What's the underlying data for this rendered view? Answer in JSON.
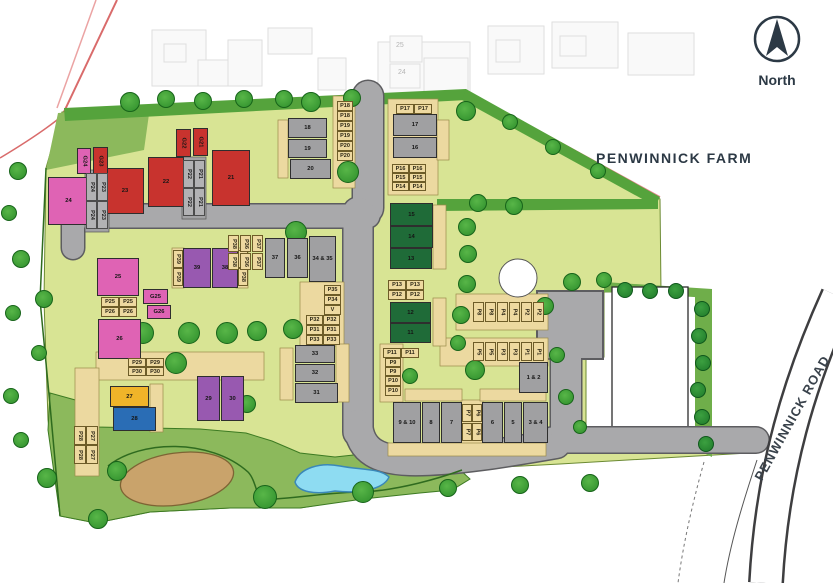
{
  "header": {
    "north_label": "North",
    "farm_label": "PENWINNICK FARM",
    "road_label": "PENWINNICK ROAD"
  },
  "background": {
    "faded_numbers": [
      "25",
      "24"
    ]
  },
  "colors": {
    "red": "#c8332e",
    "pink": "#df63b4",
    "purple": "#9859b0",
    "gray": "#a0a0a2",
    "darkgreen": "#1f6b38",
    "yellow": "#f0b429",
    "blue": "#2a6db5",
    "road": "#a9a9ab",
    "tan": "#eed9a0",
    "pale_green": "#d8e494",
    "meadow_green": "#8cb95c",
    "hedge_green": "#55a33c",
    "pond_blue": "#8edcf2",
    "sand": "#c9a36b",
    "ink": "#2c3945",
    "boundary_red": "#e07a7a"
  },
  "plots": {
    "buildings": [
      {
        "label": "21",
        "c": "red",
        "x": 212,
        "y": 150,
        "w": 38,
        "h": 56
      },
      {
        "label": "22",
        "c": "red",
        "x": 148,
        "y": 157,
        "w": 36,
        "h": 50
      },
      {
        "label": "23",
        "c": "red",
        "x": 106,
        "y": 168,
        "w": 38,
        "h": 46
      },
      {
        "label": "24",
        "c": "pink",
        "x": 48,
        "y": 177,
        "w": 41,
        "h": 48
      },
      {
        "label": "G24",
        "c": "pink",
        "x": 77,
        "y": 148,
        "w": 14,
        "h": 26,
        "r": 1
      },
      {
        "label": "G23",
        "c": "red",
        "x": 93,
        "y": 147,
        "w": 15,
        "h": 27,
        "r": 1
      },
      {
        "label": "G22",
        "c": "red",
        "x": 176,
        "y": 129,
        "w": 15,
        "h": 28,
        "r": 1
      },
      {
        "label": "G21",
        "c": "red",
        "x": 193,
        "y": 128,
        "w": 15,
        "h": 28,
        "r": 1
      },
      {
        "label": "25",
        "c": "pink",
        "x": 97,
        "y": 258,
        "w": 42,
        "h": 38
      },
      {
        "label": "G25",
        "c": "pink",
        "x": 143,
        "y": 289,
        "w": 25,
        "h": 15
      },
      {
        "label": "G26",
        "c": "pink",
        "x": 147,
        "y": 305,
        "w": 24,
        "h": 14
      },
      {
        "label": "26",
        "c": "pink",
        "x": 98,
        "y": 319,
        "w": 43,
        "h": 40
      },
      {
        "label": "39",
        "c": "purple",
        "x": 183,
        "y": 248,
        "w": 28,
        "h": 40
      },
      {
        "label": "38",
        "c": "purple",
        "x": 212,
        "y": 248,
        "w": 26,
        "h": 40
      },
      {
        "label": "37",
        "c": "gray",
        "x": 265,
        "y": 238,
        "w": 20,
        "h": 40
      },
      {
        "label": "36",
        "c": "gray",
        "x": 287,
        "y": 238,
        "w": 21,
        "h": 40
      },
      {
        "label": "34 & 35",
        "c": "gray",
        "x": 309,
        "y": 236,
        "w": 27,
        "h": 46
      },
      {
        "label": "18",
        "c": "gray",
        "x": 288,
        "y": 118,
        "w": 39,
        "h": 20
      },
      {
        "label": "19",
        "c": "gray",
        "x": 288,
        "y": 139,
        "w": 39,
        "h": 19
      },
      {
        "label": "20",
        "c": "gray",
        "x": 290,
        "y": 159,
        "w": 41,
        "h": 20
      },
      {
        "label": "17",
        "c": "gray",
        "x": 393,
        "y": 114,
        "w": 44,
        "h": 22
      },
      {
        "label": "16",
        "c": "gray",
        "x": 393,
        "y": 137,
        "w": 44,
        "h": 21
      },
      {
        "label": "15",
        "c": "darkgreen",
        "x": 390,
        "y": 203,
        "w": 43,
        "h": 23
      },
      {
        "label": "14",
        "c": "darkgreen",
        "x": 390,
        "y": 226,
        "w": 43,
        "h": 22
      },
      {
        "label": "13",
        "c": "darkgreen",
        "x": 390,
        "y": 248,
        "w": 42,
        "h": 21
      },
      {
        "label": "12",
        "c": "darkgreen",
        "x": 390,
        "y": 302,
        "w": 41,
        "h": 21
      },
      {
        "label": "11",
        "c": "darkgreen",
        "x": 390,
        "y": 323,
        "w": 41,
        "h": 20
      },
      {
        "label": "33",
        "c": "gray",
        "x": 295,
        "y": 345,
        "w": 40,
        "h": 18
      },
      {
        "label": "32",
        "c": "gray",
        "x": 295,
        "y": 364,
        "w": 40,
        "h": 18
      },
      {
        "label": "31",
        "c": "gray",
        "x": 295,
        "y": 383,
        "w": 43,
        "h": 20
      },
      {
        "label": "29",
        "c": "purple",
        "x": 197,
        "y": 376,
        "w": 23,
        "h": 45
      },
      {
        "label": "30",
        "c": "purple",
        "x": 221,
        "y": 376,
        "w": 23,
        "h": 45
      },
      {
        "label": "27",
        "c": "yellow",
        "x": 110,
        "y": 386,
        "w": 39,
        "h": 21
      },
      {
        "label": "28",
        "c": "blue",
        "x": 113,
        "y": 407,
        "w": 43,
        "h": 24
      },
      {
        "label": "9 & 10",
        "c": "gray",
        "x": 393,
        "y": 402,
        "w": 28,
        "h": 41
      },
      {
        "label": "8",
        "c": "gray",
        "x": 422,
        "y": 402,
        "w": 18,
        "h": 41
      },
      {
        "label": "7",
        "c": "gray",
        "x": 441,
        "y": 402,
        "w": 21,
        "h": 41
      },
      {
        "label": "6",
        "c": "gray",
        "x": 482,
        "y": 402,
        "w": 21,
        "h": 41
      },
      {
        "label": "5",
        "c": "gray",
        "x": 504,
        "y": 402,
        "w": 18,
        "h": 41
      },
      {
        "label": "3 & 4",
        "c": "gray",
        "x": 523,
        "y": 402,
        "w": 25,
        "h": 41
      },
      {
        "label": "1 & 2",
        "c": "gray",
        "x": 519,
        "y": 362,
        "w": 29,
        "h": 31
      }
    ]
  },
  "parking": [
    {
      "t": "P18",
      "x": 337,
      "y": 101,
      "w": 16,
      "h": 10
    },
    {
      "t": "P18",
      "x": 337,
      "y": 111,
      "w": 16,
      "h": 10
    },
    {
      "t": "P19",
      "x": 337,
      "y": 121,
      "w": 16,
      "h": 10
    },
    {
      "t": "P19",
      "x": 337,
      "y": 131,
      "w": 16,
      "h": 10
    },
    {
      "t": "P20",
      "x": 337,
      "y": 141,
      "w": 16,
      "h": 10
    },
    {
      "t": "P20",
      "x": 337,
      "y": 151,
      "w": 16,
      "h": 10
    },
    {
      "t": "P17",
      "x": 396,
      "y": 104,
      "w": 18,
      "h": 10
    },
    {
      "t": "P17",
      "x": 414,
      "y": 104,
      "w": 18,
      "h": 10
    },
    {
      "t": "P16",
      "x": 392,
      "y": 164,
      "w": 17,
      "h": 9
    },
    {
      "t": "P16",
      "x": 409,
      "y": 164,
      "w": 17,
      "h": 9
    },
    {
      "t": "P15",
      "x": 392,
      "y": 173,
      "w": 17,
      "h": 9
    },
    {
      "t": "P15",
      "x": 409,
      "y": 173,
      "w": 17,
      "h": 9
    },
    {
      "t": "P14",
      "x": 392,
      "y": 182,
      "w": 17,
      "h": 9
    },
    {
      "t": "P14",
      "x": 409,
      "y": 182,
      "w": 17,
      "h": 9
    },
    {
      "t": "P24",
      "x": 86,
      "y": 173,
      "w": 11,
      "h": 28,
      "r": 1,
      "s": "gray"
    },
    {
      "t": "P23",
      "x": 97,
      "y": 173,
      "w": 11,
      "h": 28,
      "r": 1,
      "s": "gray"
    },
    {
      "t": "P24",
      "x": 86,
      "y": 201,
      "w": 11,
      "h": 28,
      "r": 1,
      "s": "gray"
    },
    {
      "t": "P23",
      "x": 97,
      "y": 201,
      "w": 11,
      "h": 28,
      "r": 1,
      "s": "gray"
    },
    {
      "t": "P22",
      "x": 183,
      "y": 160,
      "w": 11,
      "h": 28,
      "r": 1,
      "s": "gray"
    },
    {
      "t": "P21",
      "x": 194,
      "y": 160,
      "w": 11,
      "h": 28,
      "r": 1,
      "s": "gray"
    },
    {
      "t": "P22",
      "x": 183,
      "y": 188,
      "w": 11,
      "h": 28,
      "r": 1,
      "s": "gray"
    },
    {
      "t": "P21",
      "x": 194,
      "y": 188,
      "w": 11,
      "h": 28,
      "r": 1,
      "s": "gray"
    },
    {
      "t": "P39",
      "x": 173,
      "y": 250,
      "w": 10,
      "h": 18,
      "r": 1
    },
    {
      "t": "P39",
      "x": 173,
      "y": 268,
      "w": 10,
      "h": 18,
      "r": 1
    },
    {
      "t": "P38",
      "x": 238,
      "y": 250,
      "w": 10,
      "h": 18,
      "r": 1
    },
    {
      "t": "P38",
      "x": 238,
      "y": 268,
      "w": 10,
      "h": 18,
      "r": 1
    },
    {
      "t": "P38",
      "x": 228,
      "y": 235,
      "w": 11,
      "h": 17,
      "r": 1
    },
    {
      "t": "P36",
      "x": 240,
      "y": 235,
      "w": 11,
      "h": 17,
      "r": 1
    },
    {
      "t": "P37",
      "x": 252,
      "y": 235,
      "w": 11,
      "h": 17,
      "r": 1
    },
    {
      "t": "P38",
      "x": 228,
      "y": 253,
      "w": 11,
      "h": 17,
      "r": 1
    },
    {
      "t": "P36",
      "x": 240,
      "y": 253,
      "w": 11,
      "h": 17,
      "r": 1
    },
    {
      "t": "P37",
      "x": 252,
      "y": 253,
      "w": 11,
      "h": 17,
      "r": 1
    },
    {
      "t": "P25",
      "x": 101,
      "y": 297,
      "w": 18,
      "h": 10
    },
    {
      "t": "P25",
      "x": 119,
      "y": 297,
      "w": 18,
      "h": 10
    },
    {
      "t": "P26",
      "x": 101,
      "y": 307,
      "w": 18,
      "h": 10
    },
    {
      "t": "P26",
      "x": 119,
      "y": 307,
      "w": 18,
      "h": 10
    },
    {
      "t": "P35",
      "x": 324,
      "y": 285,
      "w": 17,
      "h": 10
    },
    {
      "t": "P34",
      "x": 324,
      "y": 295,
      "w": 17,
      "h": 10
    },
    {
      "t": "V",
      "x": 324,
      "y": 305,
      "w": 17,
      "h": 10
    },
    {
      "t": "P32",
      "x": 306,
      "y": 315,
      "w": 17,
      "h": 10
    },
    {
      "t": "P32",
      "x": 323,
      "y": 315,
      "w": 17,
      "h": 10
    },
    {
      "t": "P31",
      "x": 306,
      "y": 325,
      "w": 17,
      "h": 10
    },
    {
      "t": "P31",
      "x": 323,
      "y": 325,
      "w": 17,
      "h": 10
    },
    {
      "t": "P33",
      "x": 306,
      "y": 335,
      "w": 17,
      "h": 10
    },
    {
      "t": "P33",
      "x": 323,
      "y": 335,
      "w": 17,
      "h": 10
    },
    {
      "t": "P13",
      "x": 388,
      "y": 280,
      "w": 18,
      "h": 10
    },
    {
      "t": "P13",
      "x": 406,
      "y": 280,
      "w": 18,
      "h": 10
    },
    {
      "t": "P12",
      "x": 388,
      "y": 290,
      "w": 18,
      "h": 10
    },
    {
      "t": "P12",
      "x": 406,
      "y": 290,
      "w": 18,
      "h": 10
    },
    {
      "t": "P11",
      "x": 383,
      "y": 348,
      "w": 18,
      "h": 10
    },
    {
      "t": "P11",
      "x": 401,
      "y": 348,
      "w": 18,
      "h": 10
    },
    {
      "t": "P9",
      "x": 385,
      "y": 358,
      "w": 16,
      "h": 9
    },
    {
      "t": "P9",
      "x": 385,
      "y": 367,
      "w": 16,
      "h": 9
    },
    {
      "t": "P10",
      "x": 385,
      "y": 376,
      "w": 16,
      "h": 10
    },
    {
      "t": "P10",
      "x": 385,
      "y": 386,
      "w": 16,
      "h": 10
    },
    {
      "t": "P29",
      "x": 128,
      "y": 358,
      "w": 18,
      "h": 9
    },
    {
      "t": "P29",
      "x": 146,
      "y": 358,
      "w": 18,
      "h": 9
    },
    {
      "t": "P30",
      "x": 128,
      "y": 367,
      "w": 18,
      "h": 9
    },
    {
      "t": "P30",
      "x": 146,
      "y": 367,
      "w": 18,
      "h": 9
    },
    {
      "t": "P28",
      "x": 74,
      "y": 426,
      "w": 12,
      "h": 19,
      "r": 1
    },
    {
      "t": "P27",
      "x": 86,
      "y": 426,
      "w": 12,
      "h": 19,
      "r": 1
    },
    {
      "t": "P28",
      "x": 74,
      "y": 445,
      "w": 12,
      "h": 19,
      "r": 1
    },
    {
      "t": "P27",
      "x": 86,
      "y": 445,
      "w": 12,
      "h": 19,
      "r": 1
    },
    {
      "t": "P8",
      "x": 473,
      "y": 302,
      "w": 11,
      "h": 20,
      "r": 1
    },
    {
      "t": "P8",
      "x": 485,
      "y": 302,
      "w": 11,
      "h": 20,
      "r": 1
    },
    {
      "t": "P4",
      "x": 497,
      "y": 302,
      "w": 11,
      "h": 20,
      "r": 1
    },
    {
      "t": "P4",
      "x": 509,
      "y": 302,
      "w": 11,
      "h": 20,
      "r": 1
    },
    {
      "t": "P2",
      "x": 521,
      "y": 302,
      "w": 11,
      "h": 20,
      "r": 1
    },
    {
      "t": "P2",
      "x": 533,
      "y": 302,
      "w": 11,
      "h": 20,
      "r": 1
    },
    {
      "t": "P5",
      "x": 473,
      "y": 342,
      "w": 11,
      "h": 19,
      "r": 1
    },
    {
      "t": "P5",
      "x": 485,
      "y": 342,
      "w": 11,
      "h": 19,
      "r": 1
    },
    {
      "t": "P3",
      "x": 497,
      "y": 342,
      "w": 11,
      "h": 19,
      "r": 1
    },
    {
      "t": "P3",
      "x": 509,
      "y": 342,
      "w": 11,
      "h": 19,
      "r": 1
    },
    {
      "t": "P1",
      "x": 521,
      "y": 342,
      "w": 11,
      "h": 19,
      "r": 1
    },
    {
      "t": "P1",
      "x": 533,
      "y": 342,
      "w": 11,
      "h": 19,
      "r": 1
    },
    {
      "t": "P7",
      "x": 462,
      "y": 404,
      "w": 10,
      "h": 18,
      "r": 1
    },
    {
      "t": "P6",
      "x": 472,
      "y": 404,
      "w": 10,
      "h": 18,
      "r": 1
    },
    {
      "t": "P7",
      "x": 462,
      "y": 423,
      "w": 10,
      "h": 18,
      "r": 1
    },
    {
      "t": "P6",
      "x": 472,
      "y": 423,
      "w": 10,
      "h": 18,
      "r": 1
    }
  ],
  "landscape": {
    "trees": [
      [
        130,
        102,
        10
      ],
      [
        166,
        99,
        9
      ],
      [
        203,
        101,
        9
      ],
      [
        244,
        99,
        9
      ],
      [
        284,
        99,
        9
      ],
      [
        311,
        102,
        10
      ],
      [
        352,
        98,
        9
      ],
      [
        466,
        111,
        10
      ],
      [
        510,
        122,
        8
      ],
      [
        553,
        147,
        8
      ],
      [
        598,
        171,
        8
      ],
      [
        478,
        203,
        9
      ],
      [
        514,
        206,
        9
      ],
      [
        467,
        227,
        9
      ],
      [
        468,
        254,
        9
      ],
      [
        467,
        284,
        9
      ],
      [
        461,
        315,
        9
      ],
      [
        458,
        343,
        8
      ],
      [
        572,
        282,
        9
      ],
      [
        604,
        280,
        8
      ],
      [
        296,
        232,
        11
      ],
      [
        348,
        172,
        11
      ],
      [
        143,
        333,
        11
      ],
      [
        189,
        333,
        11
      ],
      [
        227,
        333,
        11
      ],
      [
        257,
        331,
        10
      ],
      [
        293,
        329,
        10
      ],
      [
        176,
        363,
        11
      ],
      [
        247,
        404,
        9
      ],
      [
        18,
        171,
        9
      ],
      [
        9,
        213,
        8
      ],
      [
        21,
        259,
        9
      ],
      [
        44,
        299,
        9
      ],
      [
        13,
        313,
        8
      ],
      [
        39,
        353,
        8
      ],
      [
        11,
        396,
        8
      ],
      [
        21,
        440,
        8
      ],
      [
        47,
        478,
        10
      ],
      [
        117,
        471,
        10
      ],
      [
        98,
        519,
        10
      ],
      [
        265,
        497,
        12
      ],
      [
        363,
        492,
        11
      ],
      [
        448,
        488,
        9
      ],
      [
        520,
        485,
        9
      ],
      [
        590,
        483,
        9
      ],
      [
        545,
        306,
        9
      ],
      [
        475,
        370,
        10
      ],
      [
        410,
        376,
        8
      ],
      [
        557,
        355,
        8
      ],
      [
        566,
        397,
        8
      ],
      [
        580,
        427,
        7
      ]
    ],
    "bushes": [
      [
        625,
        290,
        8
      ],
      [
        650,
        291,
        8
      ],
      [
        676,
        291,
        8
      ],
      [
        702,
        309,
        8
      ],
      [
        699,
        336,
        8
      ],
      [
        703,
        363,
        8
      ],
      [
        698,
        390,
        8
      ],
      [
        702,
        417,
        8
      ],
      [
        706,
        444,
        8
      ]
    ]
  }
}
